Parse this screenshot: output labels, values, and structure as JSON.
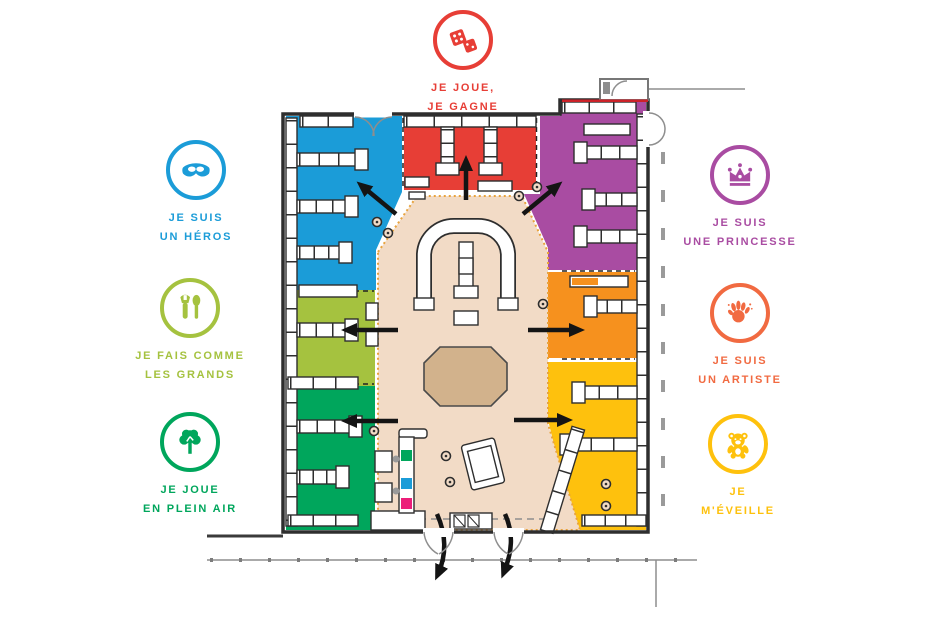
{
  "palette": {
    "wall": "#2E2E2E",
    "outside_gray": "#8E8E8E",
    "floor_beige": "#F2DBC6",
    "platform_tan": "#D2B28C",
    "boundary_dash_orange": "#E8A33D",
    "checkout_pink": "#EC1E79",
    "vestibule_red_line": "#CC2229",
    "arrow_black": "#141414"
  },
  "zones": {
    "hero_blue": "#1B9CD8",
    "game_red": "#E73E36",
    "princess_purple": "#A94CA2",
    "grands_lime": "#A5C23F",
    "plein_air_green": "#00A65C",
    "artist_orange": "#F6911E",
    "eveil_yellow": "#FEC10D"
  },
  "badges": [
    {
      "id": "je-joue-je-gagne",
      "line1": "JE JOUE,",
      "line2": "JE GAGNE",
      "color": "#E73E36",
      "icon": "dice"
    },
    {
      "id": "je-suis-un-heros",
      "line1": "JE SUIS",
      "line2": "UN HÉROS",
      "color": "#1B9CD8",
      "icon": "mask"
    },
    {
      "id": "je-fais-comme-les-grands",
      "line1": "JE FAIS COMME",
      "line2": "LES GRANDS",
      "color": "#A5C23F",
      "icon": "tools"
    },
    {
      "id": "je-joue-en-plein-air",
      "line1": "JE JOUE",
      "line2": "EN PLEIN AIR",
      "color": "#00A65C",
      "icon": "tree"
    },
    {
      "id": "je-suis-une-princesse",
      "line1": "JE SUIS",
      "line2": "UNE PRINCESSE",
      "color": "#A94CA2",
      "icon": "crown"
    },
    {
      "id": "je-suis-un-artiste",
      "line1": "JE SUIS",
      "line2": "UN ARTISTE",
      "color": "#F16A41",
      "icon": "hand"
    },
    {
      "id": "je-m-eveille",
      "line1": "JE",
      "line2": "M'ÉVEILLE",
      "color": "#FEC10D",
      "icon": "bear"
    }
  ]
}
